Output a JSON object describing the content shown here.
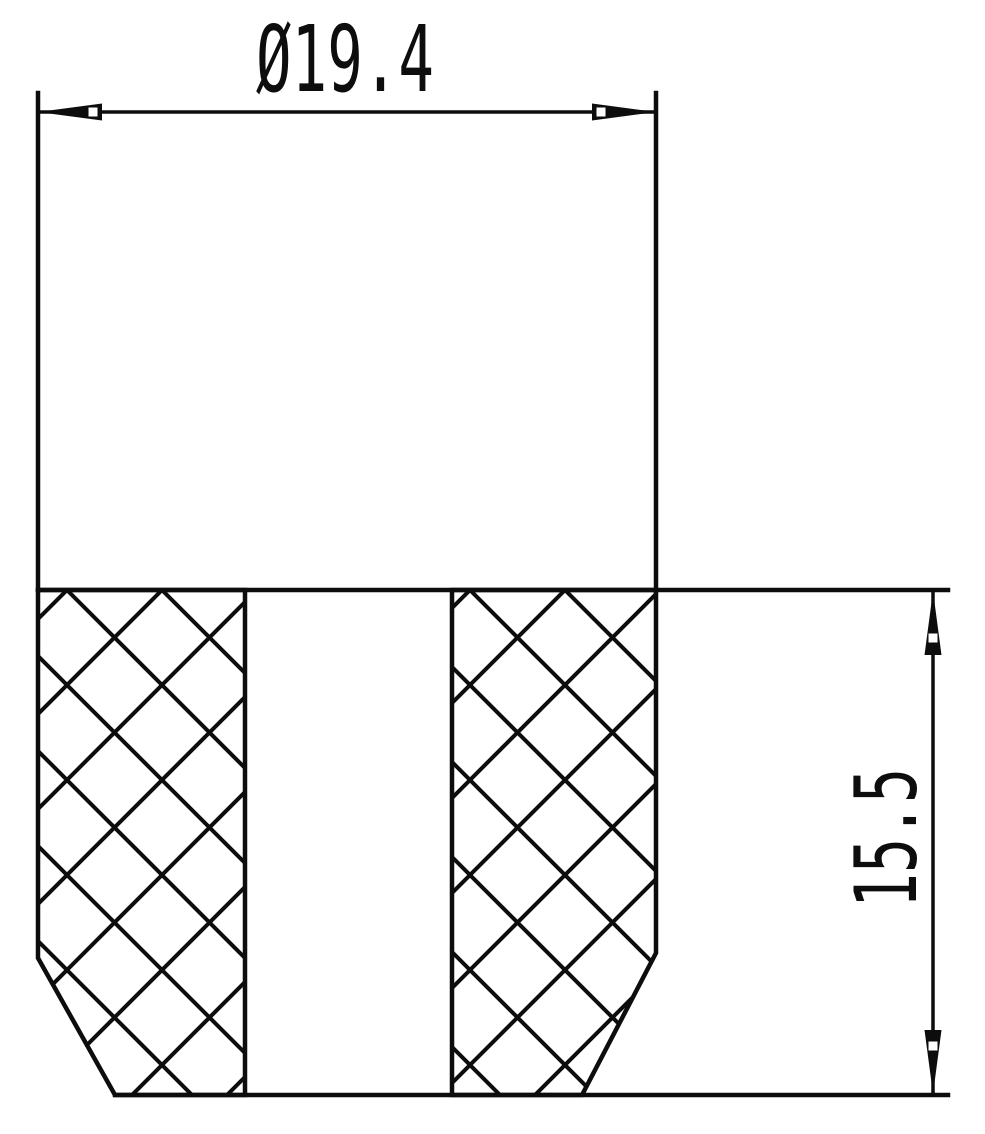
{
  "drawing": {
    "kind": "technical-section-drawing",
    "dimension_labels": {
      "diameter": "Ø19.4",
      "height": "15.5"
    },
    "colors": {
      "line": "#0d0d0d",
      "background": "#ffffff"
    }
  }
}
